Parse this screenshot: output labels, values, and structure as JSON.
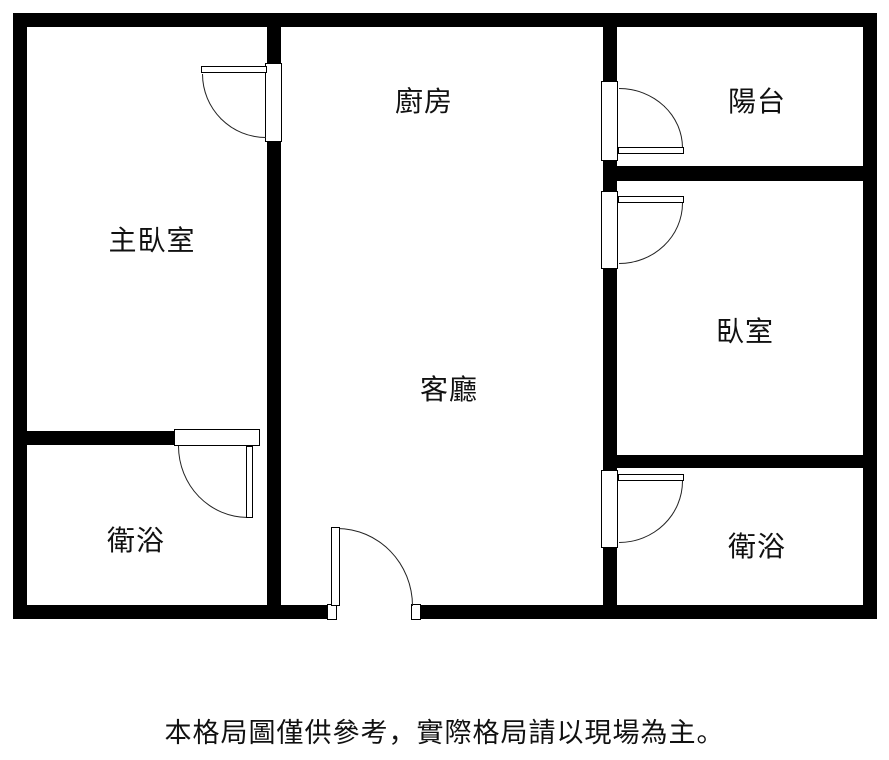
{
  "figure": {
    "type": "apartment-floor-plan"
  },
  "colors": {
    "wall": "#000000",
    "background": "#ffffff",
    "door_line": "#222222",
    "text": "#111111"
  },
  "rooms": [
    {
      "id": "master-bedroom",
      "label": "主臥室"
    },
    {
      "id": "kitchen",
      "label": "廚房"
    },
    {
      "id": "balcony",
      "label": "陽台"
    },
    {
      "id": "bedroom",
      "label": "臥室"
    },
    {
      "id": "living-room",
      "label": "客廳"
    },
    {
      "id": "bathroom-left",
      "label": "衛浴"
    },
    {
      "id": "bathroom-right",
      "label": "衛浴"
    }
  ],
  "footer": {
    "disclaimer": "本格局圖僅供參考，實際格局請以現場為主。"
  }
}
